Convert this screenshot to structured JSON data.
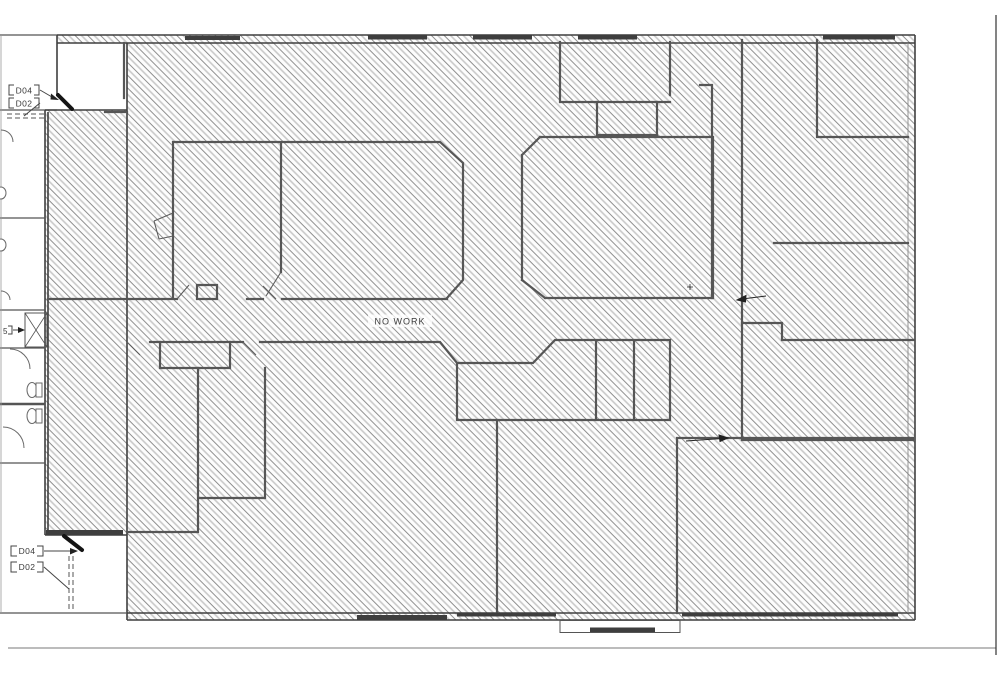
{
  "drawing": {
    "no_work_label": "NO WORK",
    "upper_door_tags": {
      "tag1": "D04",
      "tag2": "D02"
    },
    "lower_door_tags": {
      "tag1": "D04",
      "tag2": "D02"
    },
    "partial_keynote": "5",
    "colors": {
      "paper": "#ffffff",
      "hatch_line": "#8f8f8f",
      "hatch_light": "#c9c9c9",
      "wall": "#4a4a4a",
      "window_fill": "#3e3e3e",
      "door_fill": "#141414"
    }
  }
}
